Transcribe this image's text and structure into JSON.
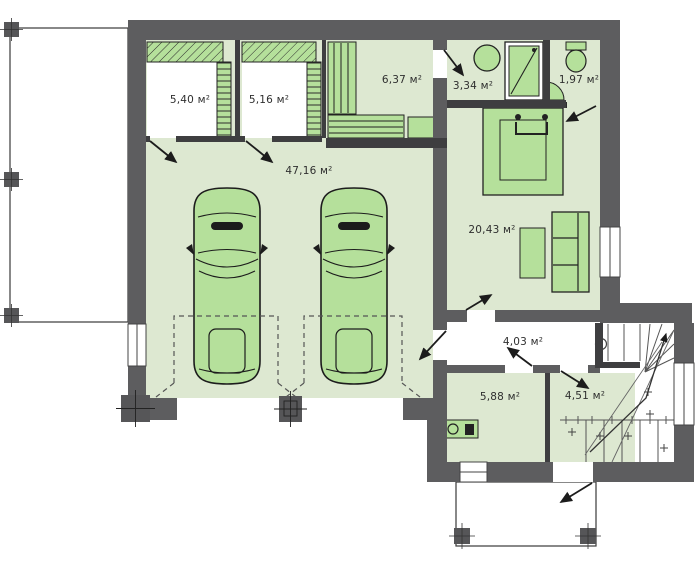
{
  "meta": {
    "type": "architectural-floor-plan",
    "floor": "ground-floor-with-garage",
    "units_symbol": "м²"
  },
  "rooms": [
    {
      "id": "storage-left",
      "area_label": "5,40 м²"
    },
    {
      "id": "storage-right",
      "area_label": "5,16 м²"
    },
    {
      "id": "dressing-room",
      "area_label": "6,37 м²"
    },
    {
      "id": "bathroom",
      "area_label": "3,34 м²"
    },
    {
      "id": "wc",
      "area_label": "1,97 м²"
    },
    {
      "id": "garage",
      "area_label": "47,16 м²"
    },
    {
      "id": "living-room",
      "area_label": "20,43 м²"
    },
    {
      "id": "hallway",
      "area_label": "4,03 м²"
    },
    {
      "id": "boiler-room",
      "area_label": "5,88 м²"
    },
    {
      "id": "stair-room",
      "area_label": "4,51 м²"
    }
  ],
  "colors": {
    "wall": "#5d5d5f",
    "wall_thin": "#3e3e40",
    "floor_green": "#dde8d1",
    "furniture_green": "#b5e09b",
    "background": "#ffffff",
    "outline": "#1c1c1c"
  },
  "furniture_icons": [
    "car-icon",
    "bed-icon",
    "sofa-icon",
    "coffee-table-icon",
    "wardrobe-icon",
    "bench-icon",
    "cabinet-icon",
    "shelving-icon",
    "shower-icon",
    "sink-icon",
    "toilet-icon",
    "boiler-icon",
    "stairs-icon",
    "door-swing-icon",
    "window-icon",
    "column-icon"
  ]
}
